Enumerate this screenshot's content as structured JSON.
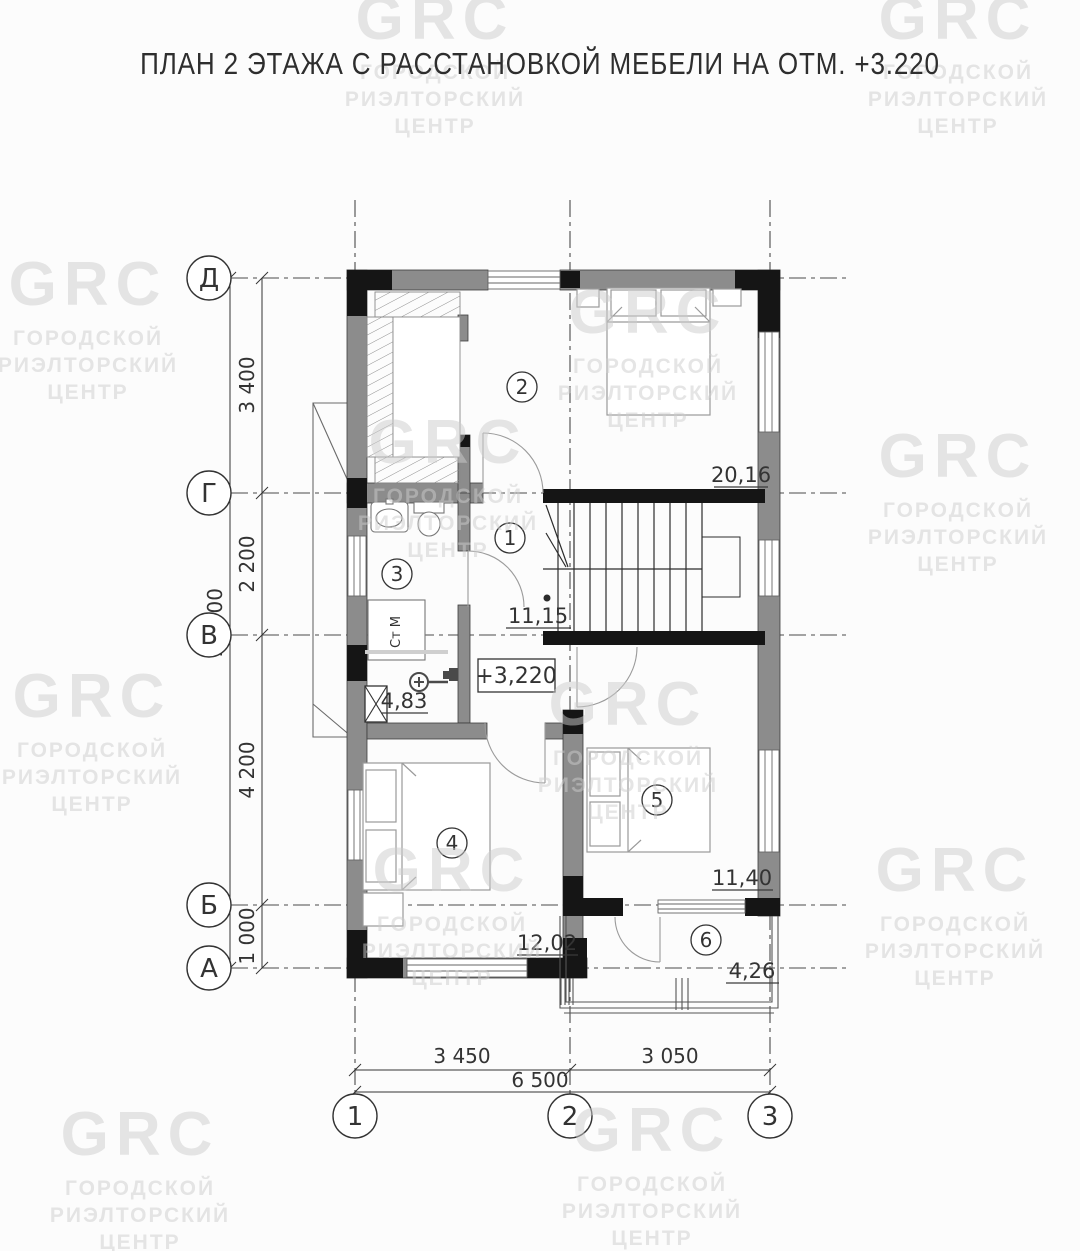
{
  "title": "ПЛАН 2 ЭТАЖА С РАССТАНОВКОЙ МЕБЕЛИ НА ОТМ. +3.220",
  "watermark": {
    "logo": "GRC",
    "lines": [
      "ГОРОДСКОЙ",
      "РИЭЛТОРСКИЙ",
      "ЦЕНТР"
    ]
  },
  "axes": {
    "rows": [
      {
        "label": "Д"
      },
      {
        "label": "Г"
      },
      {
        "label": "В"
      },
      {
        "label": "Б"
      },
      {
        "label": "А"
      }
    ],
    "cols": [
      {
        "label": "1"
      },
      {
        "label": "2"
      },
      {
        "label": "3"
      }
    ]
  },
  "dimensions": {
    "row_segments": [
      "3 400",
      "2 200",
      "4 200",
      "1 000"
    ],
    "row_total": "10 800",
    "col_segments": [
      "3 450",
      "3 050"
    ],
    "col_total": "6 500"
  },
  "rooms": [
    {
      "number": "1",
      "area": "11,15"
    },
    {
      "number": "2",
      "area": "20,16"
    },
    {
      "number": "3",
      "area": "4,83"
    },
    {
      "number": "4",
      "area": "12,02"
    },
    {
      "number": "5",
      "area": "11,40"
    },
    {
      "number": "6",
      "area": "4,26"
    }
  ],
  "elevation_mark": "+3,220",
  "equipment": {
    "washing_machine": "Ст М"
  }
}
